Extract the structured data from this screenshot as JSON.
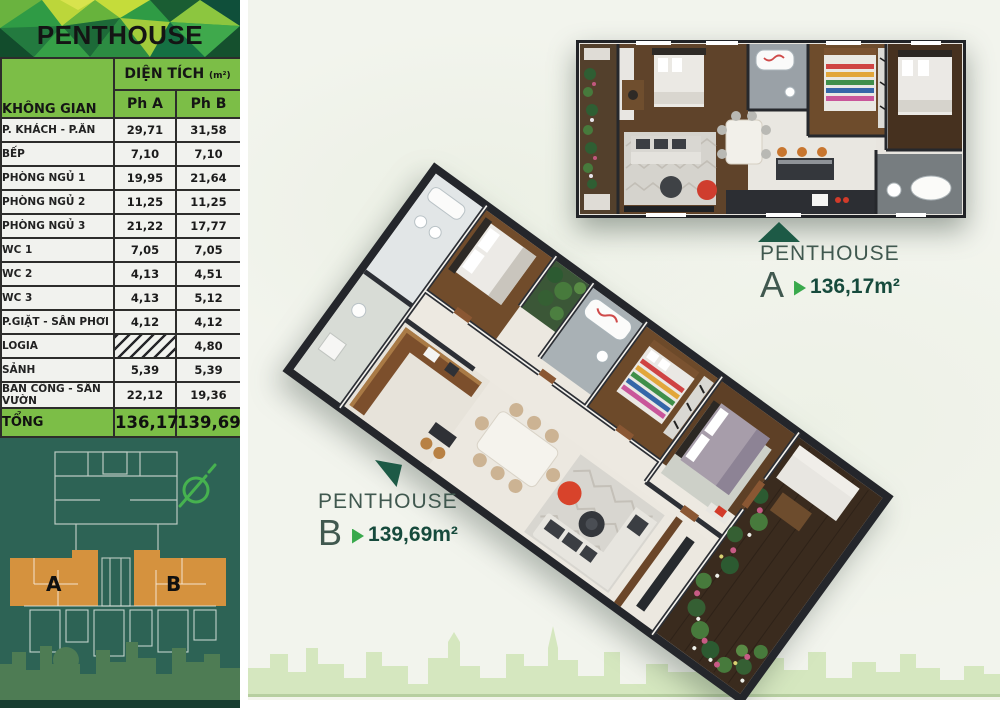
{
  "banner": {
    "title": "PENTHOUSE"
  },
  "table": {
    "space_header": "KHÔNG GIAN",
    "area_header": "DIỆN TÍCH",
    "area_unit": "(m²)",
    "columns": [
      "Ph A",
      "Ph B"
    ],
    "rows": [
      {
        "label": "P. KHÁCH - P.ĂN",
        "a": "29,71",
        "b": "31,58"
      },
      {
        "label": "BẾP",
        "a": "7,10",
        "b": "7,10"
      },
      {
        "label": "PHÒNG NGỦ 1",
        "a": "19,95",
        "b": "21,64"
      },
      {
        "label": "PHÒNG NGỦ 2",
        "a": "11,25",
        "b": "11,25"
      },
      {
        "label": "PHÒNG NGỦ 3",
        "a": "21,22",
        "b": "17,77"
      },
      {
        "label": "WC 1",
        "a": "7,05",
        "b": "7,05"
      },
      {
        "label": "WC 2",
        "a": "4,13",
        "b": "4,51"
      },
      {
        "label": "WC 3",
        "a": "4,13",
        "b": "5,12"
      },
      {
        "label": "P.GIẶT -  SÂN PHƠI",
        "a": "4,12",
        "b": "4,12"
      },
      {
        "label": "LOGIA",
        "a": "",
        "b": "4,80",
        "a_hatched": true
      },
      {
        "label": "SẢNH",
        "a": "5,39",
        "b": "5,39"
      },
      {
        "label": "BAN CÔNG - SÂN VƯỜN",
        "a": "22,12",
        "b": "19,36"
      }
    ],
    "total": {
      "label": "TỔNG",
      "a": "136,17",
      "b": "139,69"
    }
  },
  "callouts": {
    "a": {
      "name": "PENTHOUSE",
      "letter": "A",
      "area": "136,17m²"
    },
    "b": {
      "name": "PENTHOUSE",
      "letter": "B",
      "area": "139,69m²"
    }
  },
  "keyplan": {
    "unit_a": "A",
    "unit_b": "B"
  },
  "icons": {
    "north": "north-indicator-icon"
  },
  "colors": {
    "table_green": "#7cbe47",
    "panel_green": "#2d6355",
    "keyplan_orange": "#d5923e",
    "accent_green": "#39a94c",
    "dark_green_text": "#164a3c",
    "skyline_green": "#d5e7bf"
  }
}
